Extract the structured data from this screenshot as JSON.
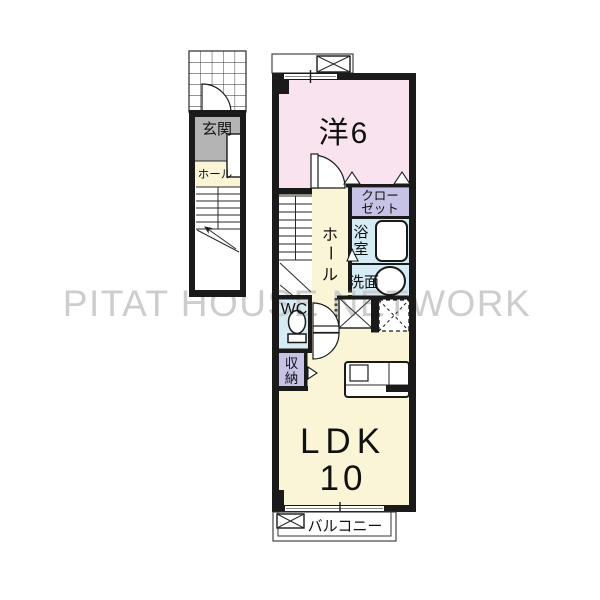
{
  "watermark": {
    "text": "PITAT HOUSE NETWORK",
    "color": "#cdcdcd"
  },
  "colors": {
    "wall": "#1a1a1a",
    "room_pink": "#f8e3ee",
    "room_yellow": "#f9f5d6",
    "room_purple": "#c6c3e6",
    "room_blue": "#d5ecf5",
    "entry_gray": "#b4b4b4"
  },
  "left_wing": {
    "entrance_label": "玄関",
    "hall_label": "ホール"
  },
  "main_unit": {
    "western_room_label": "洋6",
    "closet_lines": [
      "クロー",
      "ゼット"
    ],
    "bathroom_chars": [
      "浴",
      "室"
    ],
    "washroom_label": "洗面",
    "hall_chars": [
      "ホ",
      "ー",
      "ル"
    ],
    "wc_label": "WC",
    "storage_chars": [
      "収",
      "納"
    ],
    "ldk_line1": "LDK",
    "ldk_line2": "10"
  },
  "balcony_label": "バルコニー"
}
